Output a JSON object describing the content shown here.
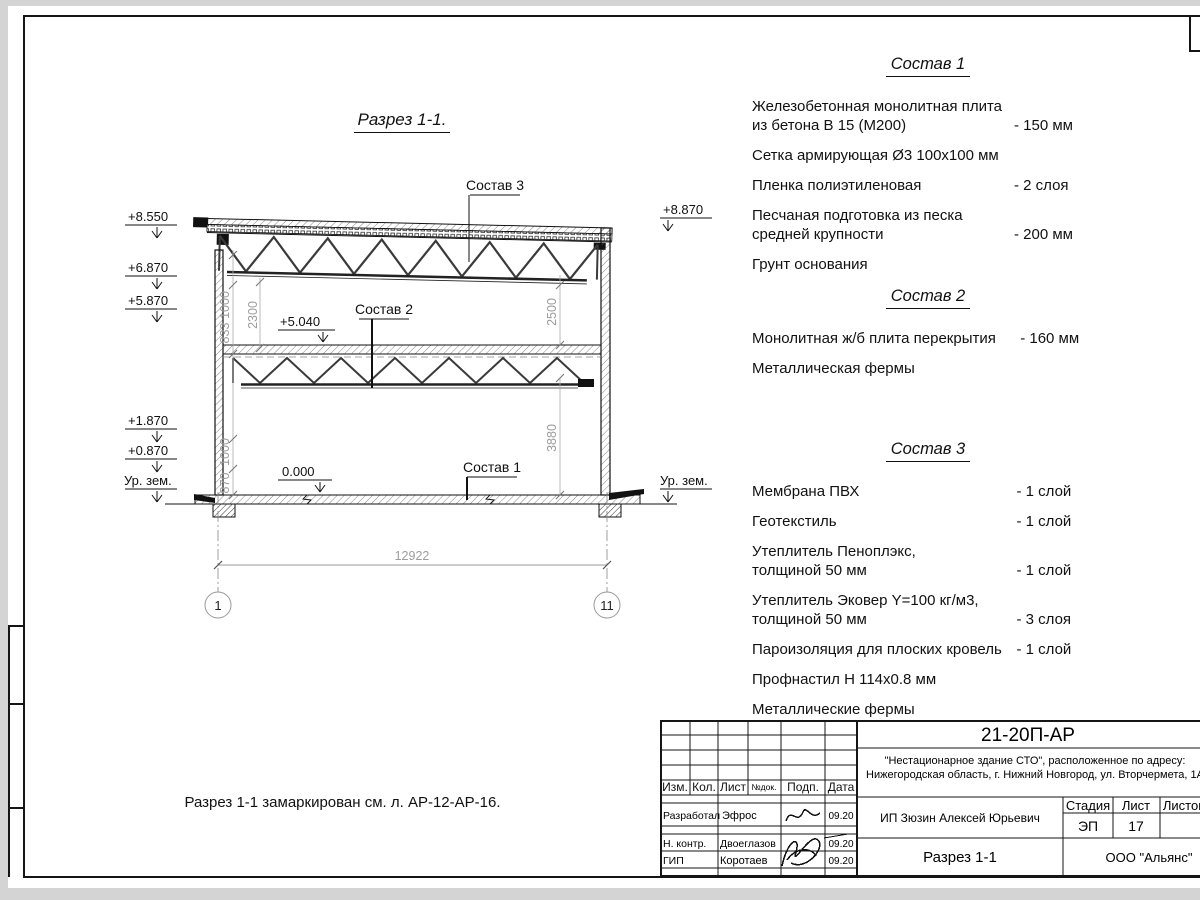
{
  "section": {
    "title": "Разрез 1-1.",
    "note": "Разрез 1-1 замаркирован см. л. АР-12-АР-16.",
    "labels": {
      "s1": "Состав 1",
      "s2": "Состав 2",
      "s3": "Состав 3"
    },
    "elev": {
      "e8550": "+8.550",
      "e6870": "+6.870",
      "e5870": "+5.870",
      "e1870": "+1.870",
      "e0870": "+0.870",
      "ur_zem": "Ур. зем.",
      "e8870": "+8.870",
      "ur_zem_r": "Ур. зем.",
      "e5040": "+5.040",
      "e0000": "0.000"
    },
    "dims": {
      "d1000a": "1000",
      "d833": "833",
      "d2300": "2300",
      "d1000b": "1000",
      "d870": "870",
      "d2500": "2500",
      "d3880": "3880",
      "total": "12922"
    },
    "axes": {
      "a1": "1",
      "a11": "11"
    }
  },
  "compositions": [
    {
      "title": "Состав 1",
      "items": [
        {
          "name": "Железобетонная  монолитная плита\nиз бетона В 15 (М200)",
          "value": "- 150 мм"
        },
        {
          "name": "Сетка армирующая Ø3 100х100 мм",
          "value": ""
        },
        {
          "name": "Пленка полиэтиленовая",
          "value": "-  2 слоя"
        },
        {
          "name": "Песчаная подготовка из песка\nсредней крупности",
          "value": "- 200 мм"
        },
        {
          "name": "Грунт основания",
          "value": ""
        }
      ]
    },
    {
      "title": "Состав 2",
      "items": [
        {
          "name": "Монолитная ж/б плита перекрытия",
          "value": "- 160 мм"
        },
        {
          "name": "Металлическая фермы",
          "value": ""
        }
      ]
    },
    {
      "title": "Состав 3",
      "items": [
        {
          "name": "Мембрана ПВХ",
          "value": "- 1 слой"
        },
        {
          "name": "Геотекстиль",
          "value": "- 1 слой"
        },
        {
          "name": "Утеплитель Пеноплэкс,\nтолщиной 50 мм",
          "value": "- 1 слой"
        },
        {
          "name": "Утеплитель Эковер Y=100 кг/м3,\nтолщиной 50 мм",
          "value": "- 3 слоя"
        },
        {
          "name": "Пароизоляция для плоских кровель",
          "value": "- 1 слой"
        },
        {
          "name": "Профнастил Н 114х0.8 мм",
          "value": ""
        },
        {
          "name": "Металлические фермы",
          "value": ""
        }
      ]
    }
  ],
  "titleblock": {
    "doc_number": "21-20П-АР",
    "project_line1": "\"Нестационарное здание СТО\", расположенное по адресу:",
    "project_line2": "Нижегородская область, г. Нижний Новгород, ул. Вторчермета, 1А",
    "client": "ИП Зюзин Алексей Юрьевич",
    "sheet_title": "Разрез 1-1",
    "company": "ООО \"Альянс\"",
    "stage_label": "Стадия",
    "sheet_label": "Лист",
    "sheets_label": "Листов",
    "stage": "ЭП",
    "sheet": "17",
    "header_cols": [
      "Изм.",
      "Кол.",
      "Лист",
      "№док.",
      "Подп.",
      "Дата"
    ],
    "rows": [
      {
        "role": "Разработал",
        "name": "Эфрос",
        "date": "09.20"
      },
      {
        "role": "Н. контр.",
        "name": "Двоеглазов",
        "date": "09.20"
      },
      {
        "role": "ГИП",
        "name": "Коротаев",
        "date": "09.20"
      }
    ]
  }
}
